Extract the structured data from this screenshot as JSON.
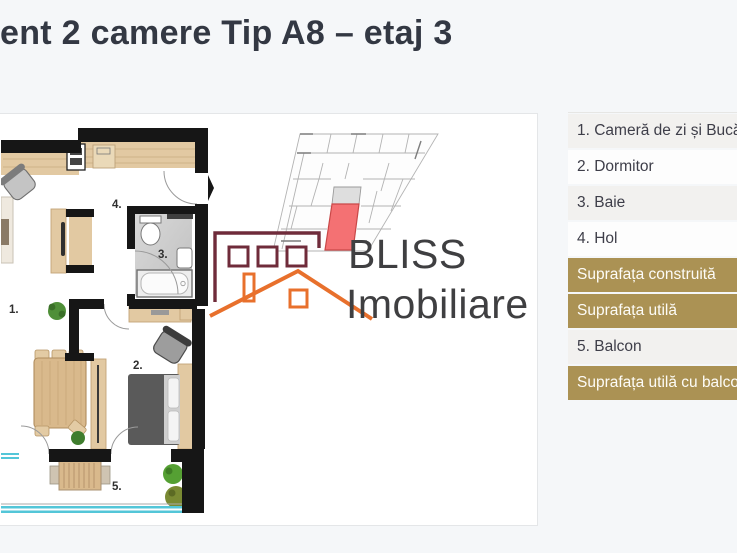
{
  "page": {
    "title": "Apartament 2 camere Tip A8 – etaj 3"
  },
  "legend": {
    "rows": [
      {
        "label": "1. Cameră de zi și Bucătărie",
        "style": "gray"
      },
      {
        "label": "2. Dormitor",
        "style": "white"
      },
      {
        "label": "3. Baie",
        "style": "gray"
      },
      {
        "label": "4. Hol",
        "style": "white"
      },
      {
        "label": "Suprafața construită",
        "style": "gold"
      },
      {
        "label": "Suprafața utilă",
        "style": "gold"
      },
      {
        "label": "5. Balcon",
        "style": "gray"
      },
      {
        "label": "Suprafața utilă cu balcon",
        "style": "gold"
      }
    ]
  },
  "logo": {
    "line1": "BLISS",
    "line2": "Imobiliare"
  },
  "floorplan": {
    "labels": {
      "living": "1.",
      "bedroom": "2.",
      "bath": "3.",
      "hall": "4.",
      "balcony": "5."
    }
  },
  "colors": {
    "accent_gold": "#ab9254",
    "title_text": "#333843",
    "logo_maroon": "#6f2b3a",
    "logo_orange": "#e8702c",
    "keyplan_highlight": "#f47173",
    "railing_blue": "#53c6d8",
    "wall_black": "#161616",
    "wood_tan": "#e2c9a2"
  }
}
